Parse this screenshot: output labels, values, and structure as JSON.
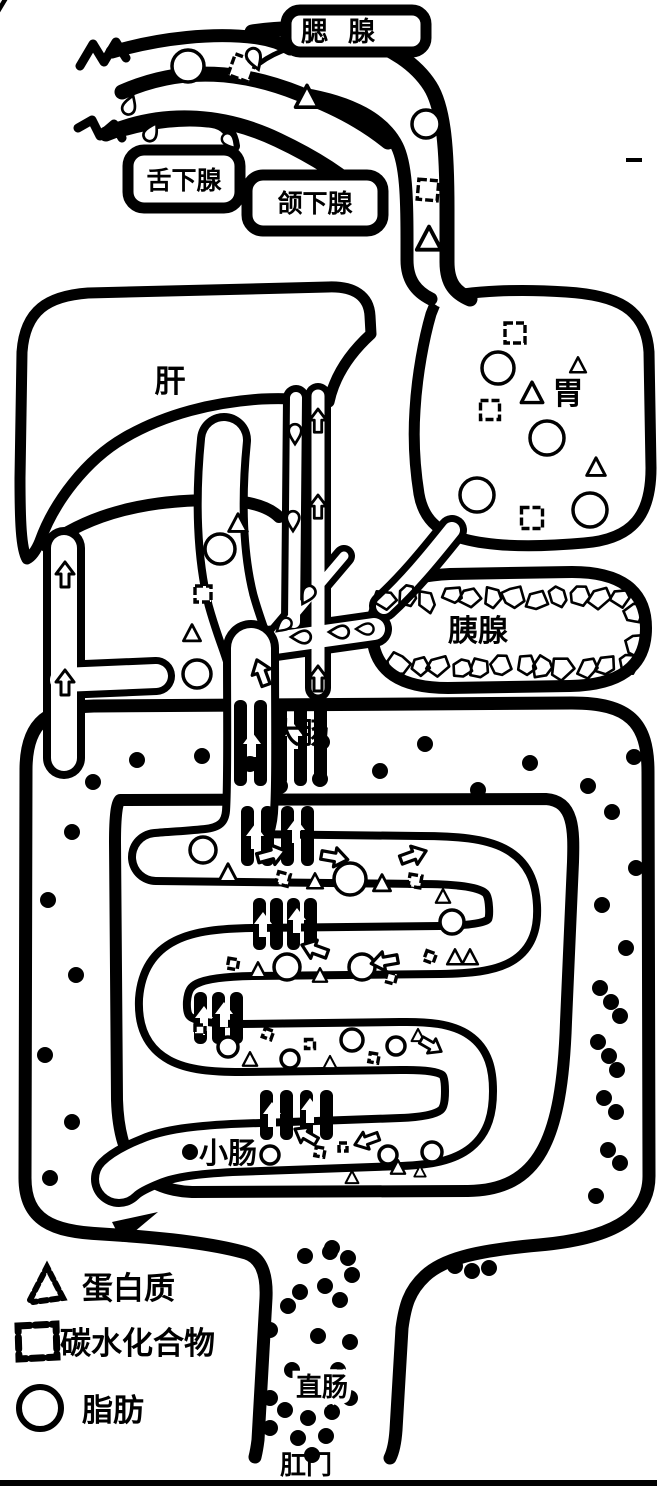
{
  "diagram": {
    "type": "anatomical-line-drawing",
    "subject": "human digestive system schematic",
    "ink_color": "#000000",
    "paper_color": "#ffffff",
    "labels": {
      "parotid": "腮腺",
      "sublingual": "舌下腺",
      "submandibular": "颌下腺",
      "liver": "肝",
      "stomach": "胃",
      "pancreas": "胰腺",
      "large_intestine": "大肠",
      "small_intestine": "小肠",
      "rectum": "直肠",
      "anus": "肛门"
    },
    "legend": {
      "items": [
        {
          "symbol": "triangle-icon",
          "label": "蛋白质"
        },
        {
          "symbol": "square-icon",
          "label": "碳水化合物"
        },
        {
          "symbol": "circle-icon",
          "label": "脂肪"
        }
      ]
    },
    "food_symbols": [
      {
        "t": "c",
        "x": 188,
        "y": 66,
        "s": 16
      },
      {
        "t": "s",
        "x": 242,
        "y": 68,
        "s": 22,
        "r": 20
      },
      {
        "t": "t",
        "x": 307,
        "y": 98,
        "s": 16
      },
      {
        "t": "d",
        "x": 255,
        "y": 60,
        "s": 10,
        "r": 160
      },
      {
        "t": "d",
        "x": 130,
        "y": 104,
        "s": 9,
        "r": 20
      },
      {
        "t": "d",
        "x": 152,
        "y": 131,
        "s": 9,
        "r": 30
      },
      {
        "t": "d",
        "x": 230,
        "y": 142,
        "s": 8,
        "r": 140
      },
      {
        "t": "c",
        "x": 426,
        "y": 124,
        "s": 14
      },
      {
        "t": "s",
        "x": 428,
        "y": 190,
        "s": 20,
        "r": 5
      },
      {
        "t": "t",
        "x": 429,
        "y": 240,
        "s": 17
      },
      {
        "t": "s",
        "x": 515,
        "y": 333,
        "s": 20
      },
      {
        "t": "c",
        "x": 498,
        "y": 368,
        "s": 16
      },
      {
        "t": "t",
        "x": 578,
        "y": 366,
        "s": 11
      },
      {
        "t": "s",
        "x": 490,
        "y": 410,
        "s": 19
      },
      {
        "t": "t",
        "x": 532,
        "y": 394,
        "s": 15
      },
      {
        "t": "c",
        "x": 547,
        "y": 438,
        "s": 17
      },
      {
        "t": "v",
        "x": 507,
        "y": 464,
        "s": 16
      },
      {
        "t": "t",
        "x": 596,
        "y": 468,
        "s": 13
      },
      {
        "t": "c",
        "x": 477,
        "y": 495,
        "s": 17
      },
      {
        "t": "s",
        "x": 532,
        "y": 518,
        "s": 21
      },
      {
        "t": "c",
        "x": 590,
        "y": 510,
        "s": 17
      },
      {
        "t": "t",
        "x": 238,
        "y": 524,
        "s": 13
      },
      {
        "t": "c",
        "x": 220,
        "y": 549,
        "s": 15
      },
      {
        "t": "s",
        "x": 203,
        "y": 594,
        "s": 16
      },
      {
        "t": "t",
        "x": 192,
        "y": 634,
        "s": 12
      },
      {
        "t": "c",
        "x": 197,
        "y": 674,
        "s": 14
      },
      {
        "t": "d",
        "x": 295,
        "y": 435,
        "s": 9,
        "r": 180
      },
      {
        "t": "d",
        "x": 293,
        "y": 522,
        "s": 9,
        "r": 180
      },
      {
        "t": "d",
        "x": 307,
        "y": 596,
        "s": 9,
        "r": 210
      },
      {
        "t": "d",
        "x": 283,
        "y": 626,
        "s": 8,
        "r": 230
      },
      {
        "t": "d",
        "x": 300,
        "y": 637,
        "s": 9,
        "r": 270
      },
      {
        "t": "d",
        "x": 338,
        "y": 632,
        "s": 9,
        "r": 270
      },
      {
        "t": "d",
        "x": 364,
        "y": 629,
        "s": 8,
        "r": 270
      },
      {
        "t": "a",
        "x": 318,
        "y": 422,
        "s": 13,
        "r": 0
      },
      {
        "t": "a",
        "x": 318,
        "y": 508,
        "s": 13,
        "r": 0
      },
      {
        "t": "a",
        "x": 65,
        "y": 576,
        "s": 14,
        "r": 0
      },
      {
        "t": "a",
        "x": 65,
        "y": 684,
        "s": 14,
        "r": 0
      },
      {
        "t": "a",
        "x": 262,
        "y": 674,
        "s": 15,
        "r": -20
      },
      {
        "t": "a",
        "x": 318,
        "y": 680,
        "s": 14,
        "r": 0
      },
      {
        "t": "c",
        "x": 203,
        "y": 850,
        "s": 13
      },
      {
        "t": "t",
        "x": 228,
        "y": 874,
        "s": 13
      },
      {
        "t": "a",
        "x": 270,
        "y": 855,
        "s": 16,
        "r": 75
      },
      {
        "t": "s",
        "x": 283,
        "y": 879,
        "s": 12,
        "r": 15
      },
      {
        "t": "t",
        "x": 315,
        "y": 882,
        "s": 11
      },
      {
        "t": "c",
        "x": 350,
        "y": 879,
        "s": 16
      },
      {
        "t": "a",
        "x": 333,
        "y": 857,
        "s": 15,
        "r": 100
      },
      {
        "t": "t",
        "x": 382,
        "y": 884,
        "s": 12
      },
      {
        "t": "s",
        "x": 415,
        "y": 881,
        "s": 12,
        "r": 10
      },
      {
        "t": "a",
        "x": 412,
        "y": 856,
        "s": 15,
        "r": 70
      },
      {
        "t": "t",
        "x": 443,
        "y": 897,
        "s": 10
      },
      {
        "t": "c",
        "x": 452,
        "y": 922,
        "s": 12
      },
      {
        "t": "s",
        "x": 430,
        "y": 957,
        "s": 10,
        "r": 20
      },
      {
        "t": "t",
        "x": 455,
        "y": 958,
        "s": 11
      },
      {
        "t": "s",
        "x": 233,
        "y": 964,
        "s": 10,
        "r": 10
      },
      {
        "t": "t",
        "x": 258,
        "y": 971,
        "s": 11
      },
      {
        "t": "c",
        "x": 287,
        "y": 967,
        "s": 13
      },
      {
        "t": "a",
        "x": 316,
        "y": 950,
        "s": 15,
        "r": -70
      },
      {
        "t": "t",
        "x": 320,
        "y": 976,
        "s": 10
      },
      {
        "t": "c",
        "x": 362,
        "y": 967,
        "s": 13
      },
      {
        "t": "a",
        "x": 386,
        "y": 961,
        "s": 15,
        "r": -100
      },
      {
        "t": "s",
        "x": 391,
        "y": 978,
        "s": 10,
        "r": 15
      },
      {
        "t": "t",
        "x": 470,
        "y": 958,
        "s": 11
      },
      {
        "t": "s",
        "x": 200,
        "y": 1030,
        "s": 10
      },
      {
        "t": "c",
        "x": 228,
        "y": 1047,
        "s": 10
      },
      {
        "t": "t",
        "x": 250,
        "y": 1060,
        "s": 10
      },
      {
        "t": "s",
        "x": 268,
        "y": 1034,
        "s": 9,
        "r": 20
      },
      {
        "t": "c",
        "x": 290,
        "y": 1059,
        "s": 9
      },
      {
        "t": "s",
        "x": 310,
        "y": 1044,
        "s": 9
      },
      {
        "t": "t",
        "x": 330,
        "y": 1063,
        "s": 9
      },
      {
        "t": "c",
        "x": 352,
        "y": 1040,
        "s": 11
      },
      {
        "t": "s",
        "x": 374,
        "y": 1058,
        "s": 9,
        "r": 10
      },
      {
        "t": "c",
        "x": 396,
        "y": 1046,
        "s": 9
      },
      {
        "t": "t",
        "x": 418,
        "y": 1036,
        "s": 9
      },
      {
        "t": "a",
        "x": 430,
        "y": 1045,
        "s": 13,
        "r": 120
      },
      {
        "t": "c",
        "x": 270,
        "y": 1155,
        "s": 9
      },
      {
        "t": "a",
        "x": 307,
        "y": 1136,
        "s": 14,
        "r": -60
      },
      {
        "t": "s",
        "x": 320,
        "y": 1152,
        "s": 9,
        "r": 10
      },
      {
        "t": "a",
        "x": 368,
        "y": 1140,
        "s": 14,
        "r": -110
      },
      {
        "t": "s",
        "x": 343,
        "y": 1147,
        "s": 8
      },
      {
        "t": "t",
        "x": 398,
        "y": 1168,
        "s": 10
      },
      {
        "t": "c",
        "x": 388,
        "y": 1155,
        "s": 9
      },
      {
        "t": "t",
        "x": 352,
        "y": 1178,
        "s": 9
      },
      {
        "t": "c",
        "x": 432,
        "y": 1152,
        "s": 10
      },
      {
        "t": "t",
        "x": 420,
        "y": 1172,
        "s": 8
      }
    ],
    "waste_dots": [
      [
        93,
        782
      ],
      [
        137,
        760
      ],
      [
        202,
        756
      ],
      [
        250,
        764
      ],
      [
        280,
        786
      ],
      [
        322,
        742
      ],
      [
        320,
        779
      ],
      [
        380,
        771
      ],
      [
        425,
        744
      ],
      [
        478,
        790
      ],
      [
        530,
        763
      ],
      [
        588,
        786
      ],
      [
        634,
        757
      ],
      [
        72,
        832
      ],
      [
        48,
        900
      ],
      [
        76,
        975
      ],
      [
        45,
        1055
      ],
      [
        72,
        1122
      ],
      [
        50,
        1178
      ],
      [
        612,
        812
      ],
      [
        636,
        868
      ],
      [
        602,
        905
      ],
      [
        626,
        948
      ],
      [
        600,
        988
      ],
      [
        611,
        1002
      ],
      [
        620,
        1016
      ],
      [
        598,
        1042
      ],
      [
        609,
        1056
      ],
      [
        617,
        1070
      ],
      [
        604,
        1098
      ],
      [
        616,
        1112
      ],
      [
        608,
        1150
      ],
      [
        620,
        1163
      ],
      [
        596,
        1196
      ],
      [
        332,
        1248
      ],
      [
        348,
        1258
      ],
      [
        352,
        1275
      ],
      [
        325,
        1286
      ],
      [
        455,
        1266
      ],
      [
        472,
        1271
      ],
      [
        489,
        1268
      ],
      [
        190,
        1152
      ],
      [
        305,
        1256
      ],
      [
        330,
        1252
      ],
      [
        300,
        1292
      ],
      [
        340,
        1300
      ],
      [
        288,
        1306
      ],
      [
        270,
        1330
      ],
      [
        318,
        1336
      ],
      [
        350,
        1342
      ],
      [
        292,
        1370
      ],
      [
        338,
        1370
      ],
      [
        270,
        1398
      ],
      [
        350,
        1398
      ],
      [
        285,
        1410
      ],
      [
        308,
        1418
      ],
      [
        332,
        1412
      ],
      [
        270,
        1428
      ],
      [
        298,
        1438
      ],
      [
        326,
        1436
      ],
      [
        312,
        1455
      ]
    ],
    "villi_bundles": [
      {
        "x": 234,
        "y": 700,
        "h": 86,
        "n": 5,
        "gap": 20,
        "arrows": [
          [
            252,
            746
          ],
          [
            294,
            738
          ]
        ]
      },
      {
        "x": 241,
        "y": 806,
        "h": 60,
        "n": 4,
        "gap": 20,
        "arrows": [
          [
            255,
            838
          ],
          [
            296,
            832
          ]
        ]
      },
      {
        "x": 253,
        "y": 898,
        "h": 52,
        "n": 4,
        "gap": 17,
        "arrows": [
          [
            263,
            926
          ],
          [
            297,
            922
          ]
        ]
      },
      {
        "x": 194,
        "y": 992,
        "h": 52,
        "n": 3,
        "gap": 18,
        "arrows": [
          [
            204,
            1020
          ],
          [
            224,
            1016
          ]
        ]
      },
      {
        "x": 260,
        "y": 1090,
        "h": 50,
        "n": 4,
        "gap": 20,
        "arrows": [
          [
            272,
            1116
          ],
          [
            310,
            1112
          ]
        ]
      }
    ],
    "pancreas_texture": {
      "style": "honeycomb",
      "rows": [
        598,
        666
      ],
      "x_start": 388,
      "x_end": 630,
      "step": 21
    }
  }
}
